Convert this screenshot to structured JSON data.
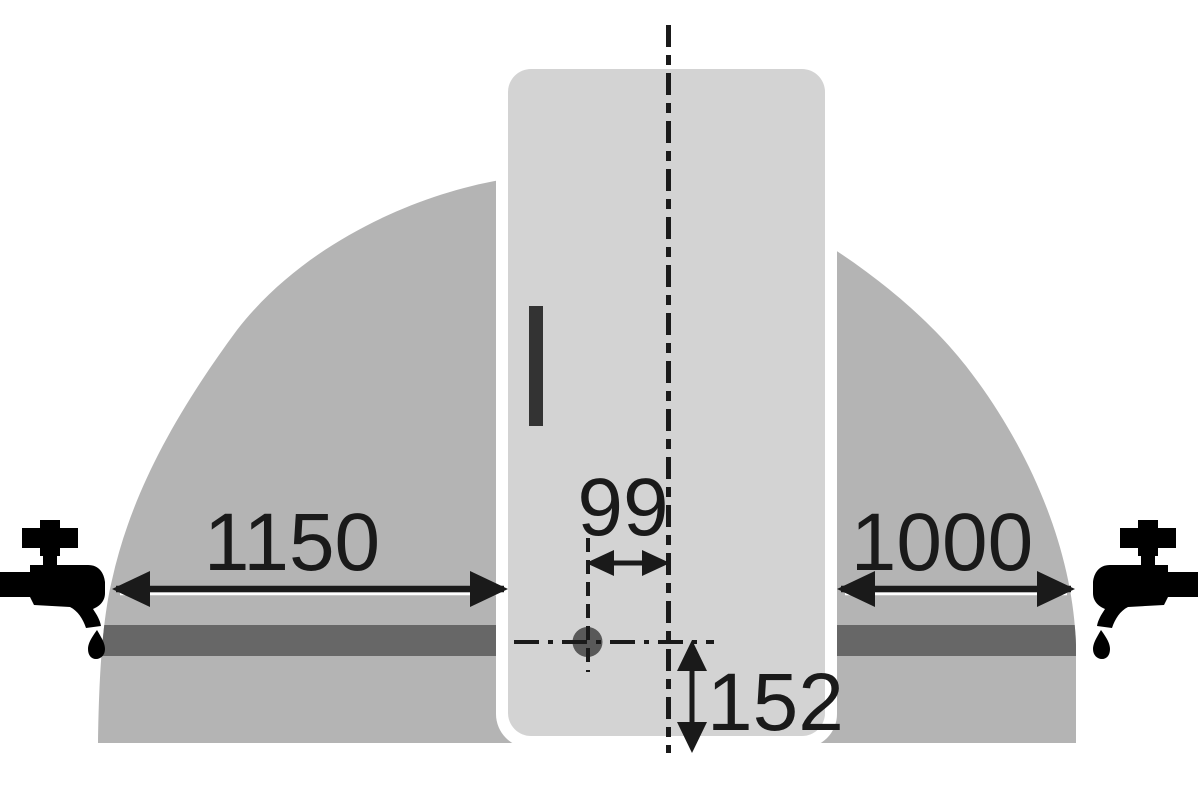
{
  "diagram": {
    "kind": "appliance-installation-clearance-diagram",
    "dimensions": {
      "left_clearance": "1150",
      "right_clearance": "1000",
      "hole_offset": "99",
      "hole_height": "152"
    },
    "colors": {
      "background": "#ffffff",
      "clearance_zone": "#b4b4b4",
      "rail_band": "#676767",
      "appliance": "#d3d3d3",
      "appliance_halo": "#ffffff",
      "handle": "#333333",
      "hole": "#595959",
      "ink": "#1a1a1a",
      "faucet": "#000000",
      "arrow_highlight": "#ffffff"
    },
    "icons": {
      "left": "water-tap-icon",
      "right": "water-tap-icon-mirrored"
    }
  }
}
